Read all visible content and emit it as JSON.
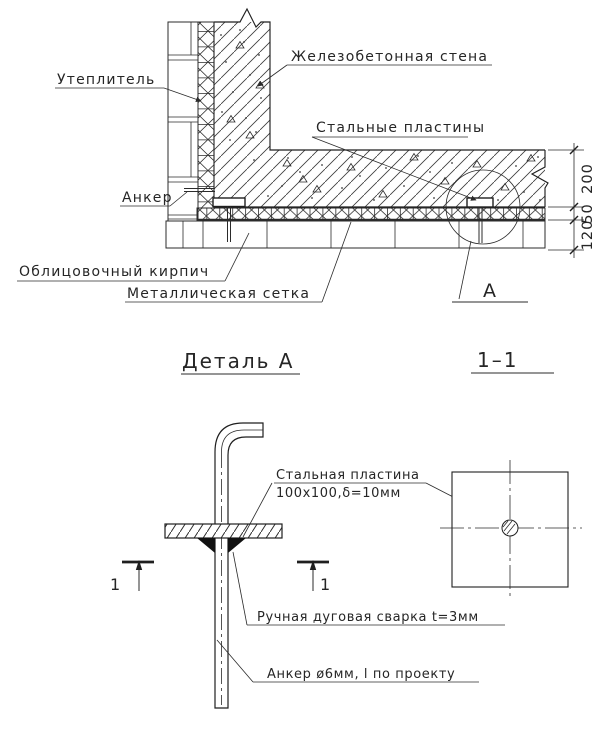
{
  "colors": {
    "line": "#2b2b2b",
    "background": "#ffffff"
  },
  "section_view": {
    "labels": {
      "insulation": "Утеплитель",
      "concrete_wall": "Железобетонная стена",
      "steel_plates": "Стальные пластины",
      "anchor": "Анкер",
      "facing_brick": "Облицовочный кирпич",
      "metal_mesh": "Металлическая сетка"
    },
    "dimensions": {
      "concrete": "200",
      "insulation": "50",
      "brick": "120"
    },
    "detail_letter": "А"
  },
  "detail_view": {
    "title": "Деталь А",
    "section_name": "1–1",
    "cut_number": "1",
    "labels": {
      "plate_line1": "Стальная пластина",
      "plate_line2": "100х100,δ=10мм",
      "weld": "Ручная дуговая сварка t=3мм",
      "anchor": "Анкер ø6мм, l по проекту"
    }
  }
}
